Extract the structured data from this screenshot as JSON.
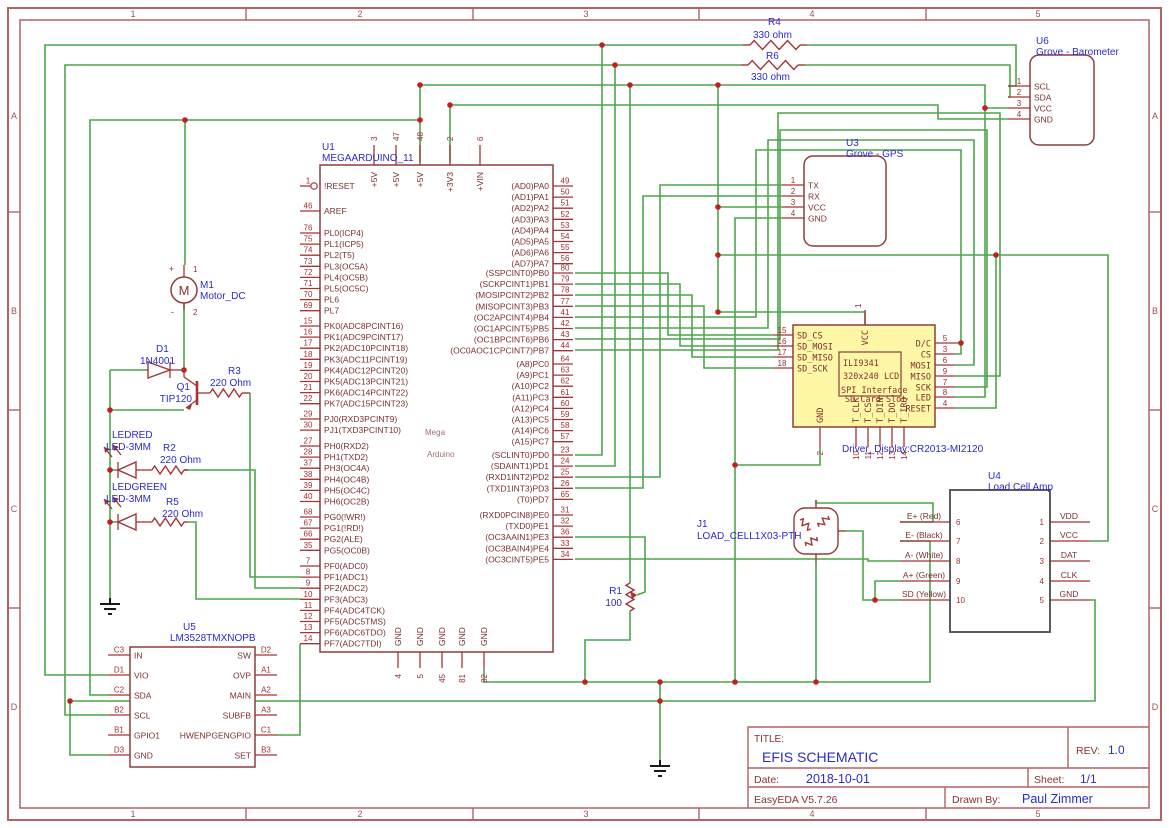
{
  "sheet": {
    "grid_cols": [
      "1",
      "2",
      "3",
      "4",
      "5"
    ],
    "grid_rows": [
      "A",
      "B",
      "C",
      "D"
    ]
  },
  "colors": {
    "wire": "#4ca64c",
    "outline": "#8e3d3d",
    "blue_text": "#2a2ad0",
    "red_text": "#d42020",
    "junction": "#c02020",
    "lcd_fill": "#fdf7a6",
    "u4_outline": "#4a4a4a",
    "sheet_border": "#b46262"
  },
  "title_block": {
    "title_label": "TITLE:",
    "title": "EFIS SCHEMATIC",
    "rev_label": "REV:",
    "rev": "1.0",
    "date_label": "Date:",
    "date": "2018-10-01",
    "sheet_label": "Sheet:",
    "sheet": "1/1",
    "tool": "EasyEDA V5.7.26",
    "drawn_by_label": "Drawn By:",
    "drawn_by": "Paul Zimmer"
  },
  "u1": {
    "ref": "U1",
    "part": "MEGAARDUINO_11",
    "center": [
      "Mega",
      "Arduino"
    ],
    "top_pins": [
      [
        "3",
        "+5V"
      ],
      [
        "47",
        "+5V"
      ],
      [
        "48",
        "+5V"
      ],
      [
        "2",
        "+3V3"
      ],
      [
        "6",
        "+VIN"
      ]
    ],
    "bottom_pins": [
      [
        "4",
        "GND"
      ],
      [
        "5",
        "GND"
      ],
      [
        "45",
        "GND"
      ],
      [
        "81",
        "GND"
      ],
      [
        "82",
        "GND"
      ]
    ],
    "left_groups": [
      [
        [
          "1",
          "!RESET"
        ]
      ],
      [
        [
          "46",
          "AREF"
        ]
      ],
      [
        [
          "76",
          "PL0(ICP4)"
        ],
        [
          "75",
          "PL1(ICP5)"
        ],
        [
          "74",
          "PL2(T5)"
        ],
        [
          "73",
          "PL3(OC5A)"
        ],
        [
          "72",
          "PL4(OC5B)"
        ],
        [
          "71",
          "PL5(OC5C)"
        ],
        [
          "70",
          "PL6"
        ],
        [
          "69",
          "PL7"
        ]
      ],
      [
        [
          "15",
          "PK0(ADC8PCINT16)"
        ],
        [
          "16",
          "PK1(ADC9PCINT17)"
        ],
        [
          "17",
          "PK2(ADC10PCINT18)"
        ],
        [
          "18",
          "PK3(ADC11PCINT19)"
        ],
        [
          "19",
          "PK4(ADC12PCINT20)"
        ],
        [
          "20",
          "PK5(ADC13PCINT21)"
        ],
        [
          "21",
          "PK6(ADC14PCINT22)"
        ],
        [
          "22",
          "PK7(ADC15PCINT23)"
        ]
      ],
      [
        [
          "29",
          "PJ0(RXD3PCINT9)"
        ],
        [
          "30",
          "PJ1(TXD3PCINT10)"
        ]
      ],
      [
        [
          "27",
          "PH0(RXD2)"
        ],
        [
          "28",
          "PH1(TXD2)"
        ],
        [
          "37",
          "PH3(OC4A)"
        ],
        [
          "38",
          "PH4(OC4B)"
        ],
        [
          "39",
          "PH5(OC4C)"
        ],
        [
          "40",
          "PH6(OC2B)"
        ]
      ],
      [
        [
          "68",
          "PG0(!WR!)"
        ],
        [
          "67",
          "PG1(!RD!)"
        ],
        [
          "66",
          "PG2(ALE)"
        ],
        [
          "35",
          "PG5(OC0B)"
        ]
      ],
      [
        [
          "7",
          "PF0(ADC0)"
        ],
        [
          "8",
          "PF1(ADC1)"
        ],
        [
          "9",
          "PF2(ADC2)"
        ],
        [
          "10",
          "PF3(ADC3)"
        ],
        [
          "11",
          "PF4(ADC4TCK)"
        ],
        [
          "12",
          "PF5(ADC5TMS)"
        ],
        [
          "13",
          "PF6(ADC6TDO)"
        ],
        [
          "14",
          "PF7(ADC7TDI)"
        ]
      ]
    ],
    "right_groups": [
      [
        [
          "49",
          "(AD0)PA0"
        ],
        [
          "50",
          "(AD1)PA1"
        ],
        [
          "51",
          "(AD2)PA2"
        ],
        [
          "52",
          "(AD3)PA3"
        ],
        [
          "53",
          "(AD4)PA4"
        ],
        [
          "54",
          "(AD5)PA5"
        ],
        [
          "55",
          "(AD6)PA6"
        ],
        [
          "56",
          "(AD7)PA7"
        ]
      ],
      [
        [
          "80",
          "(SSPCINT0)PB0"
        ],
        [
          "79",
          "(SCKPCINT1)PB1"
        ],
        [
          "78",
          "(MOSIPCINT2)PB2"
        ],
        [
          "77",
          "(MISOPCINT3)PB3"
        ],
        [
          "41",
          "(OC2APCINT4)PB4"
        ],
        [
          "42",
          "(OC1APCINT5)PB5"
        ],
        [
          "43",
          "(OC1BPCINT6)PB6"
        ],
        [
          "44",
          "(OC0AOC1CPCINT7)PB7"
        ]
      ],
      [
        [
          "64",
          "(A8)PC0"
        ],
        [
          "63",
          "(A9)PC1"
        ],
        [
          "62",
          "(A10)PC2"
        ],
        [
          "61",
          "(A11)PC3"
        ],
        [
          "60",
          "(A12)PC4"
        ],
        [
          "59",
          "(A13)PC5"
        ],
        [
          "58",
          "(A14)PC6"
        ],
        [
          "57",
          "(A15)PC7"
        ]
      ],
      [
        [
          "23",
          "(SCLINT0)PD0"
        ],
        [
          "24",
          "(SDAINT1)PD1"
        ],
        [
          "25",
          "(RXD1INT2)PD2"
        ],
        [
          "26",
          "(TXD1INT3)PD3"
        ],
        [
          "65",
          "(T0)PD7"
        ]
      ],
      [
        [
          "31",
          "(RXD0PCIN8)PE0"
        ],
        [
          "32",
          "(TXD0)PE1"
        ],
        [
          "36",
          "(OC3AAIN1)PE3"
        ],
        [
          "33",
          "(OC3BAIN4)PE4"
        ],
        [
          "34",
          "(OC3CINT5)PE5"
        ]
      ]
    ]
  },
  "u3": {
    "ref": "U3",
    "part": "Grove - GPS",
    "pins": [
      [
        "1",
        "TX"
      ],
      [
        "2",
        "RX"
      ],
      [
        "3",
        "VCC"
      ],
      [
        "4",
        "GND"
      ]
    ]
  },
  "u6": {
    "ref": "U6",
    "part": "Grove - Barometer",
    "pins": [
      [
        "1",
        "SCL"
      ],
      [
        "2",
        "SDA"
      ],
      [
        "3",
        "VCC"
      ],
      [
        "4",
        "GND"
      ]
    ]
  },
  "u5": {
    "ref": "U5",
    "part": "LM3528TMXNOPB",
    "left_pins": [
      [
        "C3",
        "IN"
      ],
      [
        "D1",
        "VIO"
      ],
      [
        "C2",
        "SDA"
      ],
      [
        "B2",
        "SCL"
      ],
      [
        "B1",
        "GPIO1"
      ],
      [
        "D3",
        "GND"
      ]
    ],
    "right_pins": [
      [
        "D2",
        "SW"
      ],
      [
        "A1",
        "OVP"
      ],
      [
        "A2",
        "MAIN"
      ],
      [
        "A3",
        "SUBFB"
      ],
      [
        "C1",
        "HWENPGENGPIO"
      ],
      [
        "B3",
        "SET"
      ]
    ]
  },
  "u4": {
    "ref": "U4",
    "part": "Load Cell Amp",
    "left_pins": [
      [
        "6",
        "E+ (Red)"
      ],
      [
        "7",
        "E- (Black)"
      ],
      [
        "8",
        "A- (White)"
      ],
      [
        "9",
        "A+ (Green)"
      ],
      [
        "10",
        "SD (Yellow)"
      ]
    ],
    "right_pins": [
      [
        "1",
        "VDD"
      ],
      [
        "2",
        "VCC"
      ],
      [
        "3",
        "DAT"
      ],
      [
        "4",
        "CLK"
      ],
      [
        "5",
        "GND"
      ]
    ]
  },
  "lcd": {
    "part_label": "Driver_Display:CR2013-MI2120",
    "left_pins": [
      [
        "15",
        "SD_CS"
      ],
      [
        "16",
        "SD_MOSI"
      ],
      [
        "17",
        "SD_MISO"
      ],
      [
        "18",
        "SD_SCK"
      ]
    ],
    "top_pins": [
      [
        "1",
        "VCC"
      ]
    ],
    "right_pins": [
      [
        "5",
        "D/C"
      ],
      [
        "3",
        "CS"
      ],
      [
        "6",
        "MOSI"
      ],
      [
        "9",
        "MISO"
      ],
      [
        "7",
        "SCK"
      ],
      [
        "8",
        "LED"
      ],
      [
        "4",
        "RESET"
      ]
    ],
    "bottom_pins": [
      [
        "2",
        "GND"
      ],
      [
        "10",
        "T_CLK"
      ],
      [
        "11",
        "T_CS"
      ],
      [
        "12",
        "T_DIN"
      ],
      [
        "13",
        "T_DO"
      ],
      [
        "14",
        "T_IRQ"
      ]
    ],
    "screen_lines": [
      "ILI9341",
      "320x240 LCD",
      "SPI Interface",
      "SD Card Slot"
    ]
  },
  "j1": {
    "ref": "J1",
    "part": "LOAD_CELL1X03-PTH"
  },
  "m1": {
    "ref": "M1",
    "part": "Motor_DC",
    "pos": "+",
    "neg": "-",
    "pin1": "1",
    "pin2": "2"
  },
  "d1": {
    "ref": "D1",
    "part": "1N4001"
  },
  "q1": {
    "ref": "Q1",
    "part": "TIP120"
  },
  "led_red": {
    "ref": "LEDRED",
    "part": "LED-3MM"
  },
  "led_green": {
    "ref": "LEDGREEN",
    "part": "LED-3MM"
  },
  "resistors": {
    "R1": {
      "ref": "R1",
      "value": "100"
    },
    "R2": {
      "ref": "R2",
      "value": "220 Ohm"
    },
    "R3": {
      "ref": "R3",
      "value": "220 Ohm"
    },
    "R4": {
      "ref": "R4",
      "value": "330 ohm"
    },
    "R5": {
      "ref": "R5",
      "value": "220 Ohm"
    },
    "R6": {
      "ref": "R6",
      "value": "330 ohm"
    }
  }
}
